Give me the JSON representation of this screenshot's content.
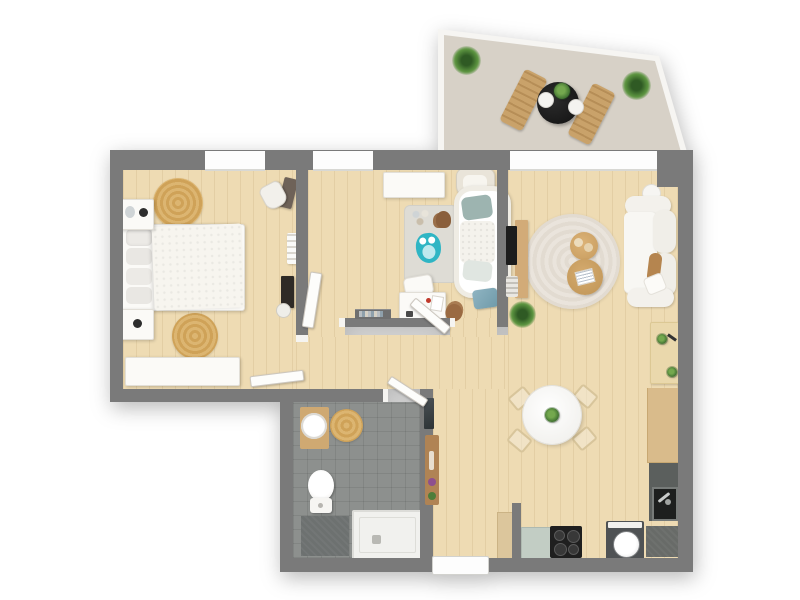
{
  "page": {
    "title": "3D apartment floor plan, top-down view",
    "background_color": "#ffffff",
    "visible_text": "none"
  },
  "palette": {
    "wall": "#7a7a7a",
    "wood_floor": "#eedbb3",
    "bathroom_tile": "#8d908e",
    "terrace_floor": "#d7d1c7",
    "white_furniture": "#fbfaf7",
    "wood_furniture": "#d2ab78",
    "jute_rug": "#d5a95f",
    "accent_teal": "#2fb5c4",
    "greenery": "#4c7d3a",
    "counter_green": "#c2cdc4",
    "appliance_dark": "#1f1f1f"
  },
  "rooms": [
    {
      "id": "terrace",
      "label": "Terrace",
      "items": [
        "potted plant",
        "potted plant",
        "black bistro table with plant and tableware",
        "sun lounger",
        "sun lounger"
      ]
    },
    {
      "id": "bedroom",
      "label": "Bedroom",
      "items": [
        "double bed with white duvet and pillows",
        "nightstand with lamp",
        "nightstand",
        "round jute rug",
        "round jute rug",
        "vanity chair",
        "vanity table",
        "ladder shelf",
        "wall desk with stool",
        "long white dresser",
        "window",
        "open door"
      ]
    },
    {
      "id": "kids-room",
      "label": "Kids room",
      "items": [
        "white wardrobe dresser",
        "nursing chair",
        "crib with teal pillows",
        "gray play rug",
        "owl plush toy",
        "teddy bear",
        "teddy bear",
        "toy set",
        "white pouf",
        "white desk",
        "teal storage basket",
        "wall shelf",
        "window",
        "open door"
      ]
    },
    {
      "id": "living-room",
      "label": "Living room",
      "items": [
        "TV on wooden board",
        "magazine rack",
        "green plant",
        "large round rug",
        "round coffee table with cushions",
        "round coffee table with magazine",
        "white sofa",
        "ball lamp",
        "brown throw",
        "cushion",
        "side table with plants",
        "wide window / terrace door"
      ]
    },
    {
      "id": "kitchen-dining",
      "label": "Kitchen / dining",
      "items": [
        "round white dining table with plant centerpiece",
        "chair",
        "chair",
        "chair",
        "chair",
        "tall cabinet",
        "green counter",
        "black stove with 4 burners",
        "washing machine",
        "dark counter",
        "sink counter with faucet",
        "wooden counter"
      ]
    },
    {
      "id": "bathroom",
      "label": "Bathroom",
      "items": [
        "wooden vanity with round sink",
        "round jute rug",
        "toilet",
        "shower tray with drain",
        "dark bath mat",
        "open door",
        "hall mirror",
        "hall console with flowers"
      ]
    },
    {
      "id": "hallway",
      "label": "Hallway",
      "items": [
        "entrance door",
        "open door leaf"
      ]
    }
  ]
}
